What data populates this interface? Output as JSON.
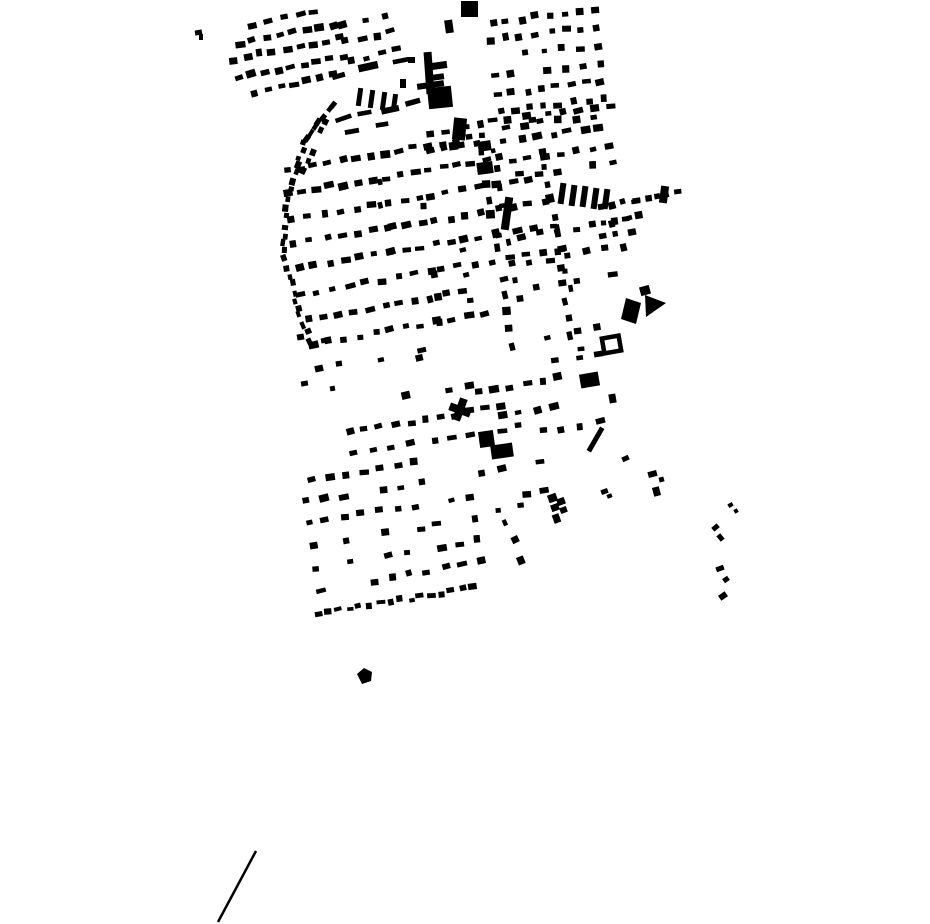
{
  "canvas": {
    "width": 930,
    "height": 924,
    "background": "#ffffff",
    "ink": "#000000"
  },
  "map": {
    "seed": 7,
    "streets": [
      [
        254,
        24,
        314,
        12,
        5,
        8,
        6,
        0
      ],
      [
        240,
        44,
        332,
        24,
        8,
        8,
        6,
        0
      ],
      [
        234,
        60,
        338,
        38,
        9,
        8,
        6,
        0
      ],
      [
        240,
        78,
        342,
        56,
        9,
        8,
        6,
        0
      ],
      [
        254,
        93,
        332,
        74,
        7,
        8,
        6,
        0
      ],
      [
        346,
        42,
        392,
        32,
        4,
        8,
        6,
        0
      ],
      [
        352,
        60,
        396,
        50,
        4,
        8,
        6,
        0
      ],
      [
        344,
        26,
        386,
        16,
        3,
        8,
        6,
        0
      ],
      [
        340,
        75,
        400,
        62,
        3,
        16,
        6,
        0
      ],
      [
        342,
        120,
        412,
        103,
        4,
        16,
        5,
        0
      ],
      [
        352,
        131,
        410,
        118,
        3,
        13,
        5,
        0.2
      ],
      [
        492,
        22,
        594,
        10,
        8,
        7,
        6,
        0
      ],
      [
        490,
        40,
        596,
        27,
        8,
        7,
        6,
        0
      ],
      [
        492,
        58,
        597,
        45,
        7,
        7,
        6,
        0.15
      ],
      [
        494,
        76,
        599,
        63,
        7,
        7,
        6,
        0.15
      ],
      [
        497,
        94,
        601,
        81,
        8,
        7,
        6,
        0
      ],
      [
        501,
        112,
        603,
        99,
        8,
        7,
        6,
        0
      ],
      [
        506,
        127,
        592,
        116,
        6,
        7,
        6,
        0
      ],
      [
        505,
        140,
        600,
        128,
        7,
        8,
        6,
        0
      ],
      [
        512,
        160,
        610,
        147,
        7,
        8,
        6,
        0
      ],
      [
        520,
        175,
        612,
        163,
        6,
        7,
        6,
        0.2
      ],
      [
        637,
        200,
        676,
        193,
        5,
        7,
        6,
        0
      ],
      [
        601,
        207,
        634,
        201,
        4,
        7,
        6,
        0
      ],
      [
        602,
        222,
        637,
        216,
        4,
        7,
        6,
        0
      ],
      [
        603,
        236,
        630,
        231,
        3,
        7,
        6,
        0
      ],
      [
        286,
        170,
        470,
        138,
        14,
        8,
        6,
        0
      ],
      [
        288,
        194,
        500,
        158,
        16,
        8,
        6,
        0
      ],
      [
        292,
        219,
        420,
        197,
        9,
        8,
        6,
        0
      ],
      [
        430,
        196,
        530,
        179,
        7,
        8,
        6,
        0
      ],
      [
        294,
        244,
        424,
        222,
        9,
        8,
        6,
        0
      ],
      [
        434,
        221,
        544,
        202,
        8,
        8,
        6,
        0
      ],
      [
        298,
        269,
        452,
        242,
        11,
        8,
        6,
        0
      ],
      [
        462,
        240,
        552,
        225,
        6,
        8,
        6,
        0
      ],
      [
        302,
        294,
        430,
        272,
        9,
        8,
        6,
        0
      ],
      [
        440,
        270,
        562,
        249,
        8,
        8,
        6,
        0
      ],
      [
        307,
        319,
        462,
        292,
        11,
        8,
        6,
        0
      ],
      [
        313,
        344,
        484,
        314,
        12,
        8,
        6,
        0
      ],
      [
        320,
        369,
        420,
        351,
        6,
        8,
        6,
        0.25
      ],
      [
        430,
        152,
        476,
        143,
        4,
        8,
        6,
        0
      ],
      [
        432,
        133,
        525,
        116,
        7,
        8,
        6,
        0
      ],
      [
        532,
        118,
        612,
        105,
        6,
        8,
        6,
        0
      ],
      [
        522,
        237,
        628,
        219,
        7,
        8,
        6,
        0.15
      ],
      [
        530,
        262,
        622,
        246,
        6,
        8,
        6,
        0.15
      ],
      [
        538,
        287,
        612,
        274,
        5,
        8,
        6,
        0.15
      ],
      [
        548,
        338,
        598,
        329,
        3,
        8,
        6,
        0.2
      ],
      [
        556,
        362,
        622,
        351,
        4,
        8,
        6,
        0.2
      ],
      [
        333,
        104,
        306,
        140,
        7,
        6,
        5,
        0
      ],
      [
        304,
        143,
        288,
        195,
        8,
        6,
        5,
        0
      ],
      [
        287,
        200,
        283,
        252,
        7,
        6,
        5,
        0
      ],
      [
        285,
        258,
        298,
        310,
        7,
        6,
        5,
        0
      ],
      [
        300,
        315,
        310,
        342,
        4,
        6,
        5,
        0
      ],
      [
        325,
        120,
        305,
        172,
        6,
        6,
        5,
        0.15
      ],
      [
        480,
        135,
        512,
        345,
        14,
        7,
        7,
        0.1
      ],
      [
        494,
        150,
        520,
        300,
        9,
        6,
        6,
        0.2
      ],
      [
        543,
        150,
        574,
        352,
        13,
        7,
        7,
        0.1
      ],
      [
        558,
        230,
        580,
        350,
        7,
        6,
        6,
        0.25
      ],
      [
        375,
        158,
        396,
        298,
        7,
        6,
        6,
        0.2
      ],
      [
        424,
        205,
        444,
        345,
        7,
        6,
        6,
        0.25
      ],
      [
        462,
        250,
        478,
        350,
        5,
        6,
        6,
        0.2
      ],
      [
        396,
        362,
        470,
        350,
        4,
        7,
        6,
        0.3
      ],
      [
        350,
        432,
        500,
        407,
        11,
        8,
        6,
        0
      ],
      [
        355,
        452,
        430,
        440,
        5,
        8,
        6,
        0.2
      ],
      [
        436,
        442,
        520,
        427,
        6,
        8,
        6,
        0
      ],
      [
        404,
        396,
        470,
        385,
        4,
        8,
        6,
        0.2
      ],
      [
        480,
        392,
        558,
        378,
        6,
        8,
        6,
        0
      ],
      [
        502,
        416,
        572,
        403,
        5,
        8,
        6,
        0.2
      ],
      [
        312,
        480,
        432,
        460,
        8,
        8,
        6,
        0.25
      ],
      [
        306,
        502,
        420,
        483,
        7,
        8,
        6,
        0.3
      ],
      [
        308,
        524,
        470,
        496,
        10,
        8,
        6,
        0.25
      ],
      [
        312,
        546,
        474,
        518,
        10,
        8,
        6,
        0.25
      ],
      [
        316,
        568,
        477,
        540,
        10,
        8,
        6,
        0.2
      ],
      [
        320,
        590,
        480,
        562,
        10,
        8,
        6,
        0.2
      ],
      [
        318,
        614,
        472,
        588,
        16,
        7,
        5,
        0
      ],
      [
        482,
        472,
        560,
        458,
        5,
        8,
        6,
        0.2
      ],
      [
        490,
        502,
        546,
        492,
        4,
        8,
        6,
        0.2
      ],
      [
        506,
        522,
        522,
        560,
        3,
        7,
        6,
        0
      ],
      [
        542,
        432,
        600,
        422,
        4,
        8,
        6,
        0.2
      ],
      [
        478,
        512,
        522,
        505,
        3,
        7,
        5,
        0.2
      ]
    ],
    "buildings": [
      [
        461,
        1,
        17,
        16,
        0
      ],
      [
        445,
        20,
        8,
        13,
        -8
      ],
      [
        425,
        52,
        8,
        42,
        -4
      ],
      [
        431,
        62,
        16,
        7,
        -8
      ],
      [
        432,
        74,
        12,
        6,
        -8
      ],
      [
        417,
        82,
        27,
        6,
        -8
      ],
      [
        428,
        87,
        24,
        21,
        -6
      ],
      [
        408,
        57,
        7,
        6,
        0
      ],
      [
        400,
        79,
        6,
        9,
        0
      ],
      [
        357,
        88,
        5,
        18,
        8
      ],
      [
        369,
        90,
        5,
        18,
        8
      ],
      [
        381,
        92,
        5,
        18,
        8
      ],
      [
        392,
        94,
        5,
        16,
        8
      ],
      [
        453,
        118,
        13,
        22,
        6
      ],
      [
        449,
        142,
        9,
        8,
        -8
      ],
      [
        478,
        141,
        13,
        10,
        -8
      ],
      [
        477,
        162,
        16,
        12,
        -8
      ],
      [
        503,
        197,
        8,
        33,
        8
      ],
      [
        559,
        183,
        6,
        21,
        8
      ],
      [
        570,
        185,
        6,
        21,
        8
      ],
      [
        581,
        186,
        6,
        21,
        8
      ],
      [
        592,
        188,
        6,
        21,
        8
      ],
      [
        603,
        189,
        6,
        20,
        8
      ],
      [
        660,
        186,
        8,
        17,
        8
      ],
      [
        640,
        286,
        10,
        9,
        -15
      ],
      [
        580,
        373,
        19,
        14,
        -10
      ],
      [
        609,
        394,
        7,
        9,
        -10
      ],
      [
        479,
        431,
        15,
        16,
        -8
      ],
      [
        491,
        444,
        22,
        14,
        -8
      ],
      [
        593,
        426,
        5,
        27,
        30
      ],
      [
        548,
        494,
        9,
        8,
        -20
      ],
      [
        557,
        498,
        8,
        7,
        -20
      ],
      [
        551,
        504,
        8,
        7,
        -20
      ],
      [
        560,
        507,
        7,
        6,
        -20
      ],
      [
        553,
        514,
        7,
        9,
        -20
      ],
      [
        601,
        489,
        7,
        5,
        -20
      ],
      [
        607,
        494,
        5,
        4,
        -20
      ],
      [
        456,
        398,
        8,
        23,
        20
      ],
      [
        449,
        406,
        22,
        8,
        20
      ],
      [
        622,
        456,
        7,
        5,
        -25
      ],
      [
        648,
        471,
        9,
        6,
        -15
      ],
      [
        659,
        477,
        5,
        5,
        -15
      ],
      [
        653,
        487,
        7,
        9,
        -15
      ],
      [
        728,
        503,
        5,
        4,
        -30
      ],
      [
        734,
        509,
        4,
        4,
        -30
      ],
      [
        712,
        525,
        7,
        5,
        -40
      ],
      [
        718,
        534,
        5,
        7,
        -40
      ],
      [
        716,
        566,
        8,
        5,
        -20
      ],
      [
        723,
        577,
        6,
        5,
        -35
      ],
      [
        719,
        593,
        8,
        6,
        -35
      ],
      [
        195,
        30,
        7,
        5,
        -10
      ],
      [
        199,
        34,
        4,
        6,
        0
      ],
      [
        297,
        334,
        7,
        6,
        -10
      ],
      [
        321,
        338,
        6,
        5,
        -10
      ],
      [
        301,
        381,
        7,
        5,
        -10
      ],
      [
        330,
        386,
        5,
        5,
        -10
      ]
    ],
    "polygons": [
      {
        "name": "parallelogram-building",
        "points": [
          [
            626,
            298
          ],
          [
            641,
            303
          ],
          [
            636,
            324
          ],
          [
            621,
            319
          ]
        ]
      },
      {
        "name": "triangle-building",
        "points": [
          [
            645,
            295
          ],
          [
            666,
            303
          ],
          [
            646,
            317
          ]
        ]
      },
      {
        "name": "south-blob-building",
        "points": [
          [
            357,
            674
          ],
          [
            364,
            668
          ],
          [
            372,
            672
          ],
          [
            371,
            681
          ],
          [
            362,
            684
          ]
        ]
      }
    ],
    "outline_square": {
      "x": 603,
      "y": 337,
      "w": 17,
      "h": 15,
      "rot": -10,
      "stroke": 4.5
    },
    "line": {
      "x1": 218,
      "y1": 922,
      "x2": 256,
      "y2": 851,
      "width": 2.5
    }
  }
}
